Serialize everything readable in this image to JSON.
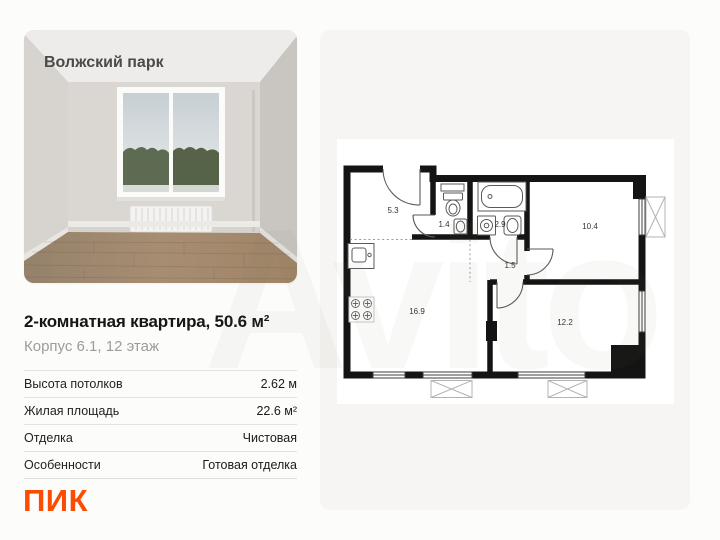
{
  "page": {
    "background": "#fcfcfb"
  },
  "watermark": {
    "text": "Avito"
  },
  "photo_card": {
    "project_title": "Волжский парк"
  },
  "listing": {
    "title": "2-комнатная квартира, 50.6 м²",
    "subtitle": "Корпус 6.1, 12 этаж",
    "specs": [
      {
        "label": "Высота потолков",
        "value": "2.62 м"
      },
      {
        "label": "Жилая площадь",
        "value": "22.6 м²"
      },
      {
        "label": "Отделка",
        "value": "Чистовая"
      },
      {
        "label": "Особенности",
        "value": "Готовая отделка"
      }
    ]
  },
  "brand": {
    "name": "ПИК",
    "color": "#FC4C02"
  },
  "floorplan": {
    "wall_color": "#141414",
    "rooms": [
      {
        "id": "hallway",
        "area": "5.3"
      },
      {
        "id": "wc",
        "area": "1.4"
      },
      {
        "id": "bathroom",
        "area": "2.9"
      },
      {
        "id": "bedroom",
        "area": "10.4"
      },
      {
        "id": "inner-corridor",
        "area": "1.5"
      },
      {
        "id": "kitchen-living-room",
        "area": "16.9"
      },
      {
        "id": "room",
        "area": "12.2"
      }
    ]
  }
}
